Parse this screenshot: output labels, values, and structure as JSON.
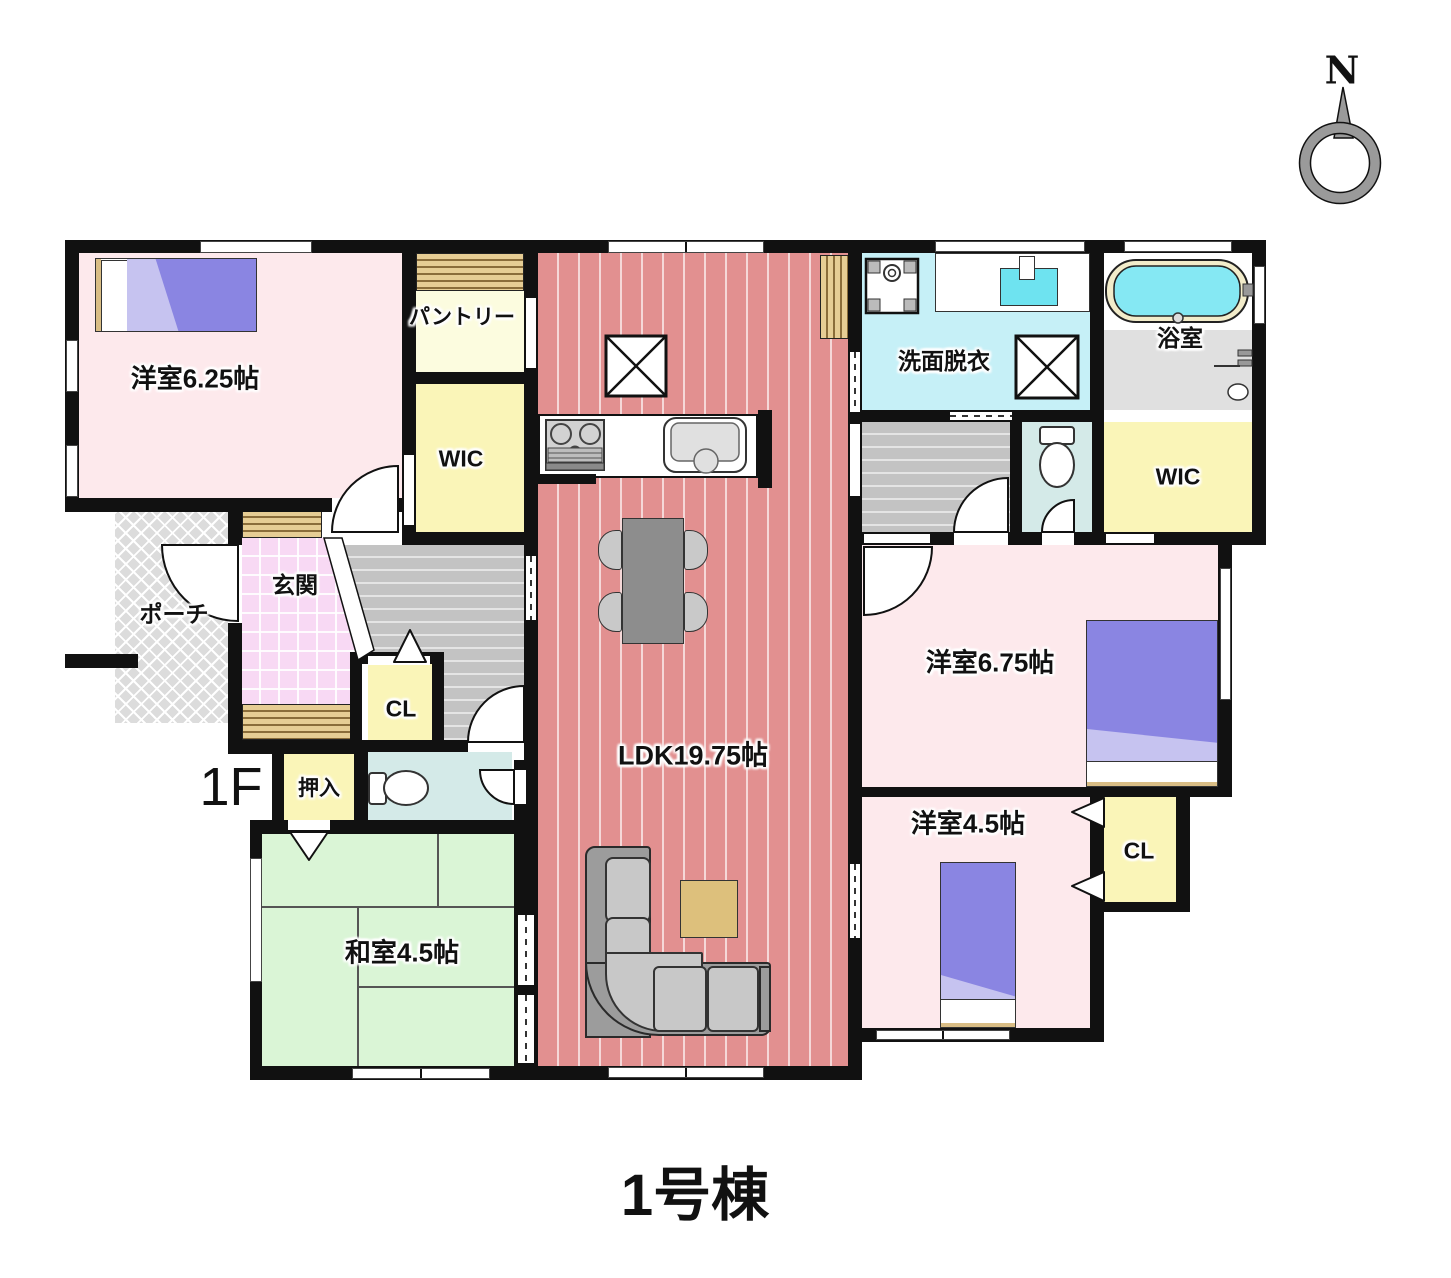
{
  "building_title": "1号棟",
  "floor_label": "1F",
  "compass": {
    "north_label": "N"
  },
  "rooms": {
    "western_6_25": {
      "label": "洋室6.25帖"
    },
    "pantry": {
      "label": "パントリー"
    },
    "wic_left": {
      "label": "WIC"
    },
    "ldk": {
      "label": "LDK19.75帖"
    },
    "washroom": {
      "label": "洗面脱衣"
    },
    "bathroom": {
      "label": "浴室"
    },
    "wic_right": {
      "label": "WIC"
    },
    "western_6_75": {
      "label": "洋室6.75帖"
    },
    "western_4_5": {
      "label": "洋室4.5帖"
    },
    "closet_bottom_right": {
      "label": "CL"
    },
    "closet_hall": {
      "label": "CL"
    },
    "entrance": {
      "label": "玄関"
    },
    "porch": {
      "label": "ポーチ"
    },
    "oshiire": {
      "label": "押入"
    },
    "japanese_4_5": {
      "label": "和室4.5帖"
    }
  },
  "colors": {
    "wall": "#111111",
    "ldk_floor": "#e29090",
    "bedroom_pink": "#fde9ec",
    "tatami_green": "#daf5d6",
    "closet_yellow": "#faf5b8",
    "pantry_cream": "#fcfcdf",
    "washroom_cyan": "#c6f0f7",
    "toilet_teal": "#d4eae8",
    "entrance_pink": "#f8d9f4",
    "hallway_gray": "#c3c3c3",
    "porch_gray": "#dcdcdc",
    "cabinet_tan": "#e6cd94",
    "bed_purple": "#8a85e2",
    "bathtub_water": "#85e8f3",
    "table_wood": "#ddc07c"
  }
}
